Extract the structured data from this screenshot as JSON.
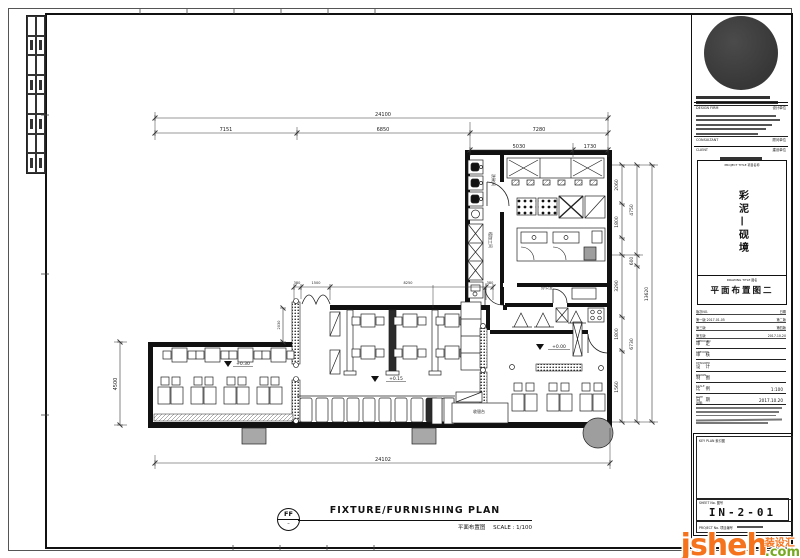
{
  "footer": {
    "ref_top": "FF",
    "ref_bottom": "–",
    "title": "FIXTURE/FURNISHING PLAN",
    "subtitle": "平面布置图",
    "scale": "SCALE : 1/100"
  },
  "plan": {
    "labels": [
      {
        "t": "24100",
        "x": 383,
        "y": 116,
        "fs": 5
      },
      {
        "t": "7151",
        "x": 226,
        "y": 131,
        "fs": 5
      },
      {
        "t": "6850",
        "x": 383,
        "y": 131,
        "fs": 5
      },
      {
        "t": "7280",
        "x": 539,
        "y": 131,
        "fs": 5
      },
      {
        "t": "5030",
        "x": 519,
        "y": 148,
        "fs": 5
      },
      {
        "t": "1730",
        "x": 590,
        "y": 148,
        "fs": 5
      },
      {
        "t": "24102",
        "x": 383,
        "y": 461,
        "fs": 5
      },
      {
        "t": "4500",
        "x": 117,
        "y": 384,
        "r": -90,
        "fs": 5
      },
      {
        "t": "2060",
        "x": 618,
        "y": 185,
        "r": -90,
        "fs": 4.5
      },
      {
        "t": "1800",
        "x": 618,
        "y": 222,
        "r": -90,
        "fs": 4.5
      },
      {
        "t": "3290",
        "x": 618,
        "y": 286,
        "r": -90,
        "fs": 4.5
      },
      {
        "t": "1800",
        "x": 618,
        "y": 334,
        "r": -90,
        "fs": 4.5
      },
      {
        "t": "1560",
        "x": 618,
        "y": 387,
        "r": -90,
        "fs": 4.5
      },
      {
        "t": "4750",
        "x": 633,
        "y": 210,
        "r": -90,
        "fs": 4.5
      },
      {
        "t": "600",
        "x": 633,
        "y": 261,
        "r": -90,
        "fs": 4.5
      },
      {
        "t": "6730",
        "x": 633,
        "y": 344,
        "r": -90,
        "fs": 4.5
      },
      {
        "t": "13620",
        "x": 648,
        "y": 294,
        "r": -90,
        "fs": 4.5
      },
      {
        "t": "380",
        "x": 297,
        "y": 284,
        "fs": 3.5
      },
      {
        "t": "1500",
        "x": 316,
        "y": 284,
        "fs": 3.5
      },
      {
        "t": "8250",
        "x": 408,
        "y": 284,
        "fs": 3.5
      },
      {
        "t": "380",
        "x": 490,
        "y": 284,
        "fs": 3.5
      },
      {
        "t": "2030",
        "x": 280,
        "y": 325,
        "r": -90,
        "fs": 3.5
      },
      {
        "t": "+0.30",
        "x": 243,
        "y": 365,
        "fs": 4.5
      },
      {
        "t": "+0.15",
        "x": 396,
        "y": 380,
        "fs": 4.5
      },
      {
        "t": "+0.00",
        "x": 559,
        "y": 348,
        "fs": 4.5
      },
      {
        "t": "洗碗间",
        "x": 492,
        "y": 180,
        "r": 90,
        "fs": 4
      },
      {
        "t": "粗加工间",
        "x": 489,
        "y": 240,
        "r": 90,
        "fs": 4
      },
      {
        "t": "办公室",
        "x": 547,
        "y": 289,
        "fs": 4
      },
      {
        "t": "收银台",
        "x": 479,
        "y": 413,
        "fs": 4
      }
    ]
  },
  "titleblock": {
    "design_firm_en": "DESIGN FIRM",
    "design_firm_cn": "设计单位",
    "consultant_en": "CONSULTANT",
    "consultant_cn": "顾问单位",
    "client_en": "CLIENT",
    "client_cn": "建设单位",
    "project_title_label": "PROJECT TITLE 项目名称",
    "project_name": "彩泥—砚境",
    "drawing_title_label": "DRAWING TITLE 图名",
    "drawing_title": "平面布置图二",
    "revisions": [
      [
        "版次NO.",
        "日期"
      ],
      [
        "第一版  2017.01.05",
        "第二版"
      ],
      [
        "第三版",
        "第四版"
      ],
      [
        "第五版",
        "2017.10.20"
      ]
    ],
    "fields": [
      [
        "APPROVED",
        "审 定",
        ""
      ],
      [
        "CHECKED",
        "审 核",
        ""
      ],
      [
        "DESIGNED",
        "设 计",
        ""
      ],
      [
        "DRAWN",
        "制 图",
        ""
      ],
      [
        "SCALE",
        "比 例",
        "1:100"
      ],
      [
        "DATE",
        "日 期",
        "2017.10.20"
      ]
    ],
    "notes_label": "说明:",
    "keyplan_label": "KEY PLAN 索引图",
    "sheetno_label": "SHEET No. 图号",
    "sheet_no": "IN-2-01",
    "projno_label": "PROJECT No. 项目编号"
  },
  "watermark": {
    "brand": "jsheh",
    "tld": ".com",
    "cn": "装设汇"
  }
}
